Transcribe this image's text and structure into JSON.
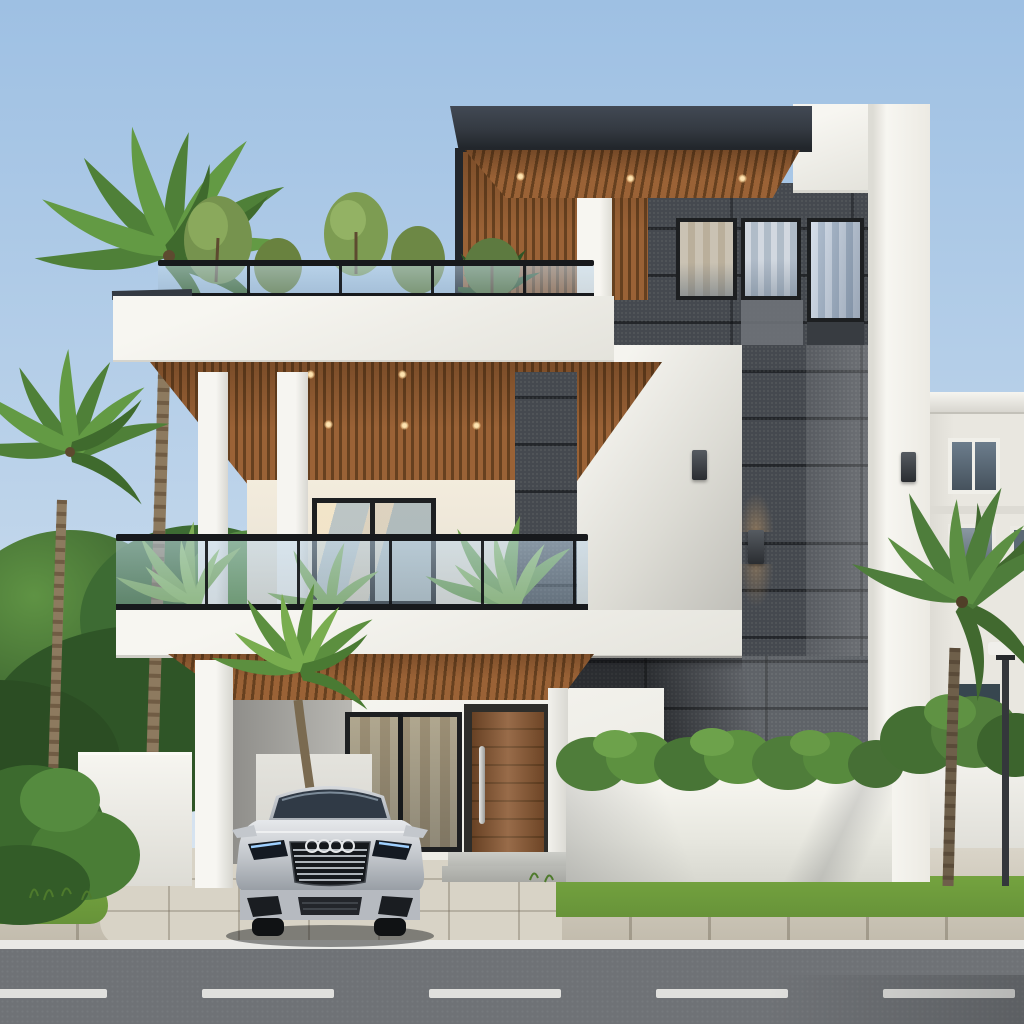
{
  "meta": {
    "scene": "modern-villa-exterior-3d-render",
    "time_of_day": "day",
    "visible_text": "none"
  },
  "palette": {
    "sky_top": "#9ec0e3",
    "sky_mid": "#bcd3ea",
    "sky_low": "#d9e5f1",
    "wall_white": "#f7f6f1",
    "wall_shade": "#e4e3dc",
    "fascia": "#343a42",
    "fascia_deep": "#22262b",
    "wood": "#9a6236",
    "wood_dark": "#66401f",
    "stone": "#45494f",
    "stone_dark": "#383c41",
    "stone_mid": "#595e64",
    "stone_light": "#6e7278",
    "glass": "#aabccd",
    "glass_deep": "#39424e",
    "rail": "#17191c",
    "green_deep": "#2f5527",
    "green": "#4a7d36",
    "green_light": "#6ea44a",
    "palm": "#5c8f3f",
    "palm_light": "#8ab95c",
    "trunk": "#8d7a5f",
    "road": "#6f7276",
    "road_line": "#e9e9e6",
    "paver": "#cdc6b6",
    "drive": "#d8d3c6",
    "grass": "#679339",
    "door_wood": "#8a5730",
    "door_dark": "#6e4522",
    "car_silver": "#c9ccd0",
    "neighbor_wall": "#e9e7e0",
    "warm_light": "#ffd9a0"
  },
  "scene": {
    "objects": [
      "sky",
      "modern-villa",
      "dark-stone-tower",
      "curtained-windows",
      "vertical-blind-window",
      "rooftop-terrace",
      "rooftop-shrubs",
      "glass-railings",
      "wood-slat-soffits",
      "white-pillars",
      "balcony",
      "sliding-glass-door",
      "balcony-palms",
      "wall-sconces",
      "carport",
      "silver-sedan",
      "wooden-entry-door",
      "entry-steps",
      "planter-wall",
      "garden-hedges",
      "palm-trees",
      "lawn",
      "driveway",
      "paved-sidewalk",
      "asphalt-road",
      "lane-markings",
      "street-lamp",
      "neighbor-building"
    ],
    "counts": {
      "balcony_pillars": 2,
      "tower_windows": 3,
      "rooftop_shrubs": 5,
      "lane_dashes": 5,
      "wall_sconces": 3
    },
    "vehicle": {
      "type": "sedan",
      "color": "silver",
      "emblem": "four-interlocked-rings",
      "view": "front"
    }
  }
}
